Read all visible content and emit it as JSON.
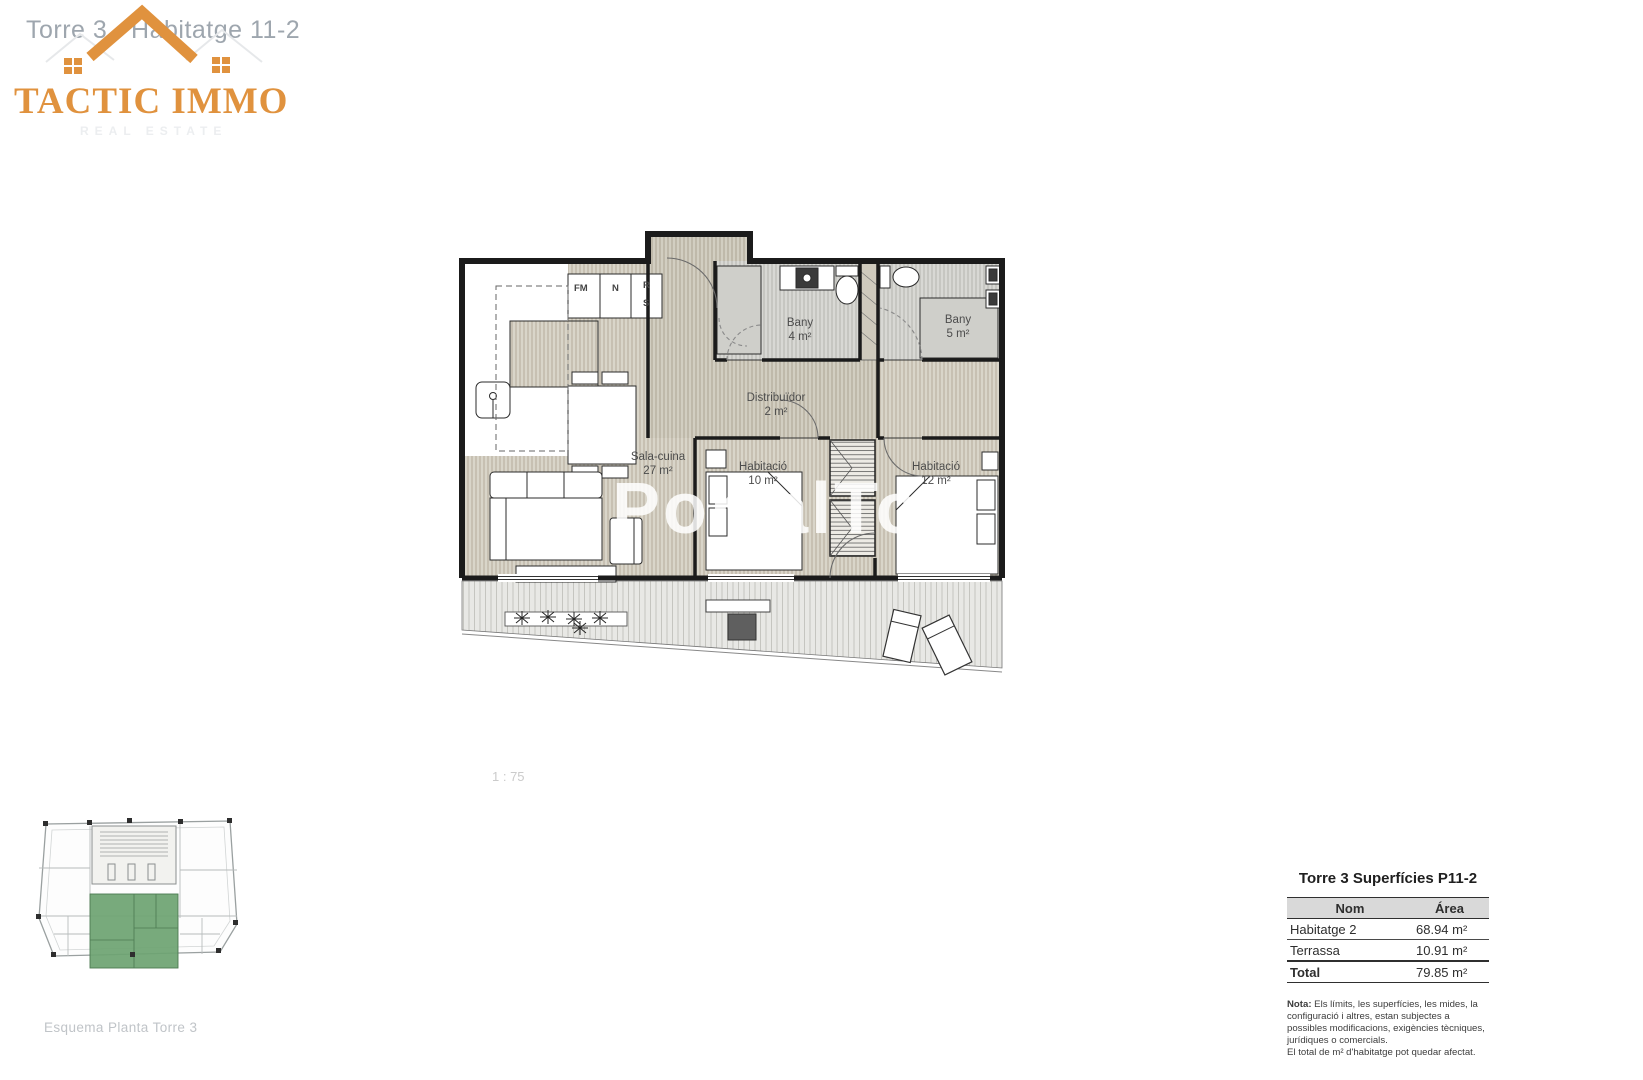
{
  "page": {
    "title": "Torre 3 - Habitatge 11-2",
    "scale_label": "1 : 75",
    "watermark": "PortalTop"
  },
  "logo": {
    "name": "TACTIC IMMO",
    "tagline": "REAL ESTATE",
    "accent_color": "#E0923E"
  },
  "floorplan": {
    "rooms": {
      "sala": {
        "name": "Sala-cuina",
        "area": "27 m²"
      },
      "bany4": {
        "name": "Bany",
        "area": "4 m²"
      },
      "bany5": {
        "name": "Bany",
        "area": "5 m²"
      },
      "distribuidor": {
        "name": "Distribuïdor",
        "area": "2 m²"
      },
      "hab10": {
        "name": "Habitació",
        "area": "10 m²"
      },
      "hab12": {
        "name": "Habitació",
        "area": "12 m²"
      }
    },
    "kitchen_units": {
      "fm": "FM",
      "n": "N",
      "r": "R",
      "s": "S"
    },
    "wall_color": "#1b1b1b",
    "floor_color": "#d9d5c9",
    "terrace_color": "#e8e8e5"
  },
  "mini_plan": {
    "caption": "Esquema Planta Torre 3",
    "highlight_color": "#6ca371"
  },
  "summary_table": {
    "title": "Torre 3 Superfícies P11-2",
    "columns": {
      "name": "Nom",
      "area": "Área"
    },
    "rows": [
      {
        "name": "Habitatge 2",
        "area": "68.94 m²"
      },
      {
        "name": "Terrassa",
        "area": "10.91 m²"
      },
      {
        "name": "Total",
        "area": "79.85 m²"
      }
    ],
    "note_prefix": "Nota:",
    "note_body": " Els límits, les superfícies, les mides, la configuració i altres, estan subjectes a possibles modificacions, exigències tècniques, jurídiques o comercials.",
    "note_footer": "El total de m² d'habitatge pot quedar afectat."
  }
}
